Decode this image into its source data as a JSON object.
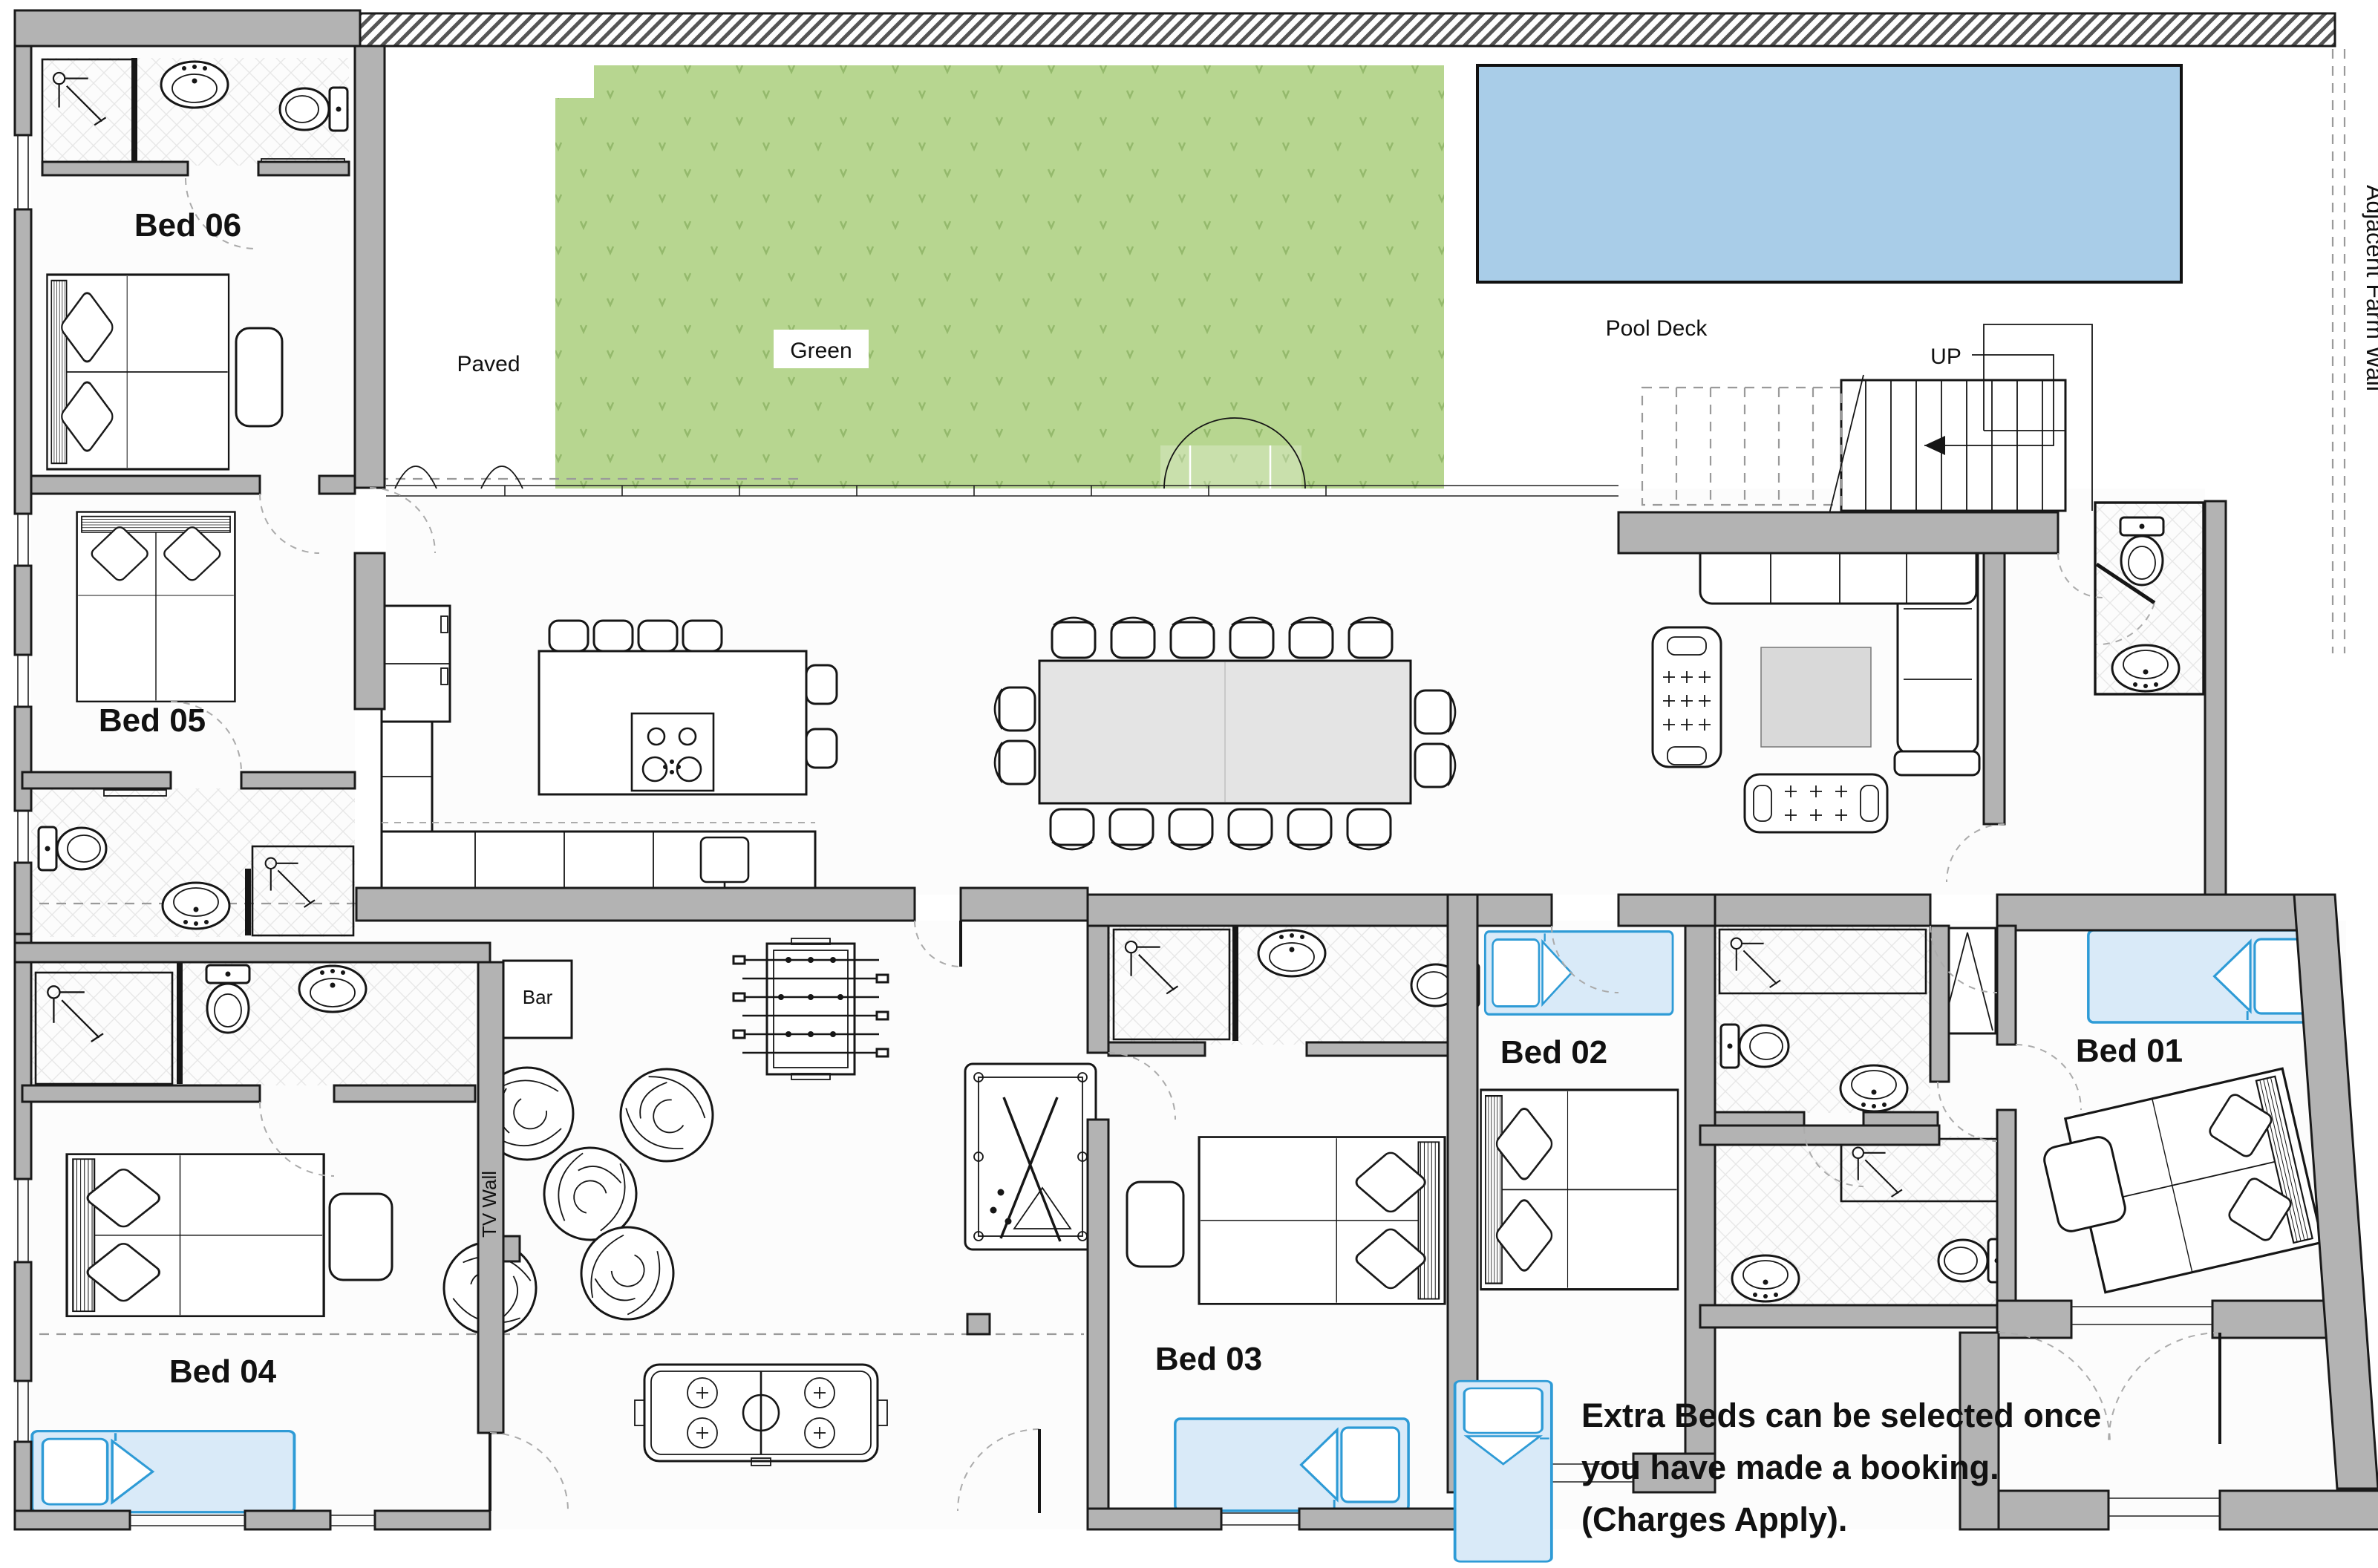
{
  "labels": {
    "bed06": "Bed 06",
    "bed05": "Bed 05",
    "bed04": "Bed 04",
    "bed03": "Bed 03",
    "bed02": "Bed 02",
    "bed01": "Bed 01",
    "green": "Green",
    "paved": "Paved",
    "pool_deck": "Pool Deck",
    "up": "UP",
    "bar": "Bar",
    "tv_wall": "TV Wall",
    "adjacent_farm_wall": "Adjacent Farm Wall"
  },
  "note": {
    "line1": "Extra Beds can be selected once",
    "line2": "you have made a booking.",
    "line3": "(Charges Apply)."
  },
  "colors": {
    "wall": "#b3b3b3",
    "lawn": "#b7d690",
    "pool": "#a9cde8",
    "extra_bed_stroke": "#2e9bd6",
    "extra_bed_fill": "#d9eaf8"
  }
}
